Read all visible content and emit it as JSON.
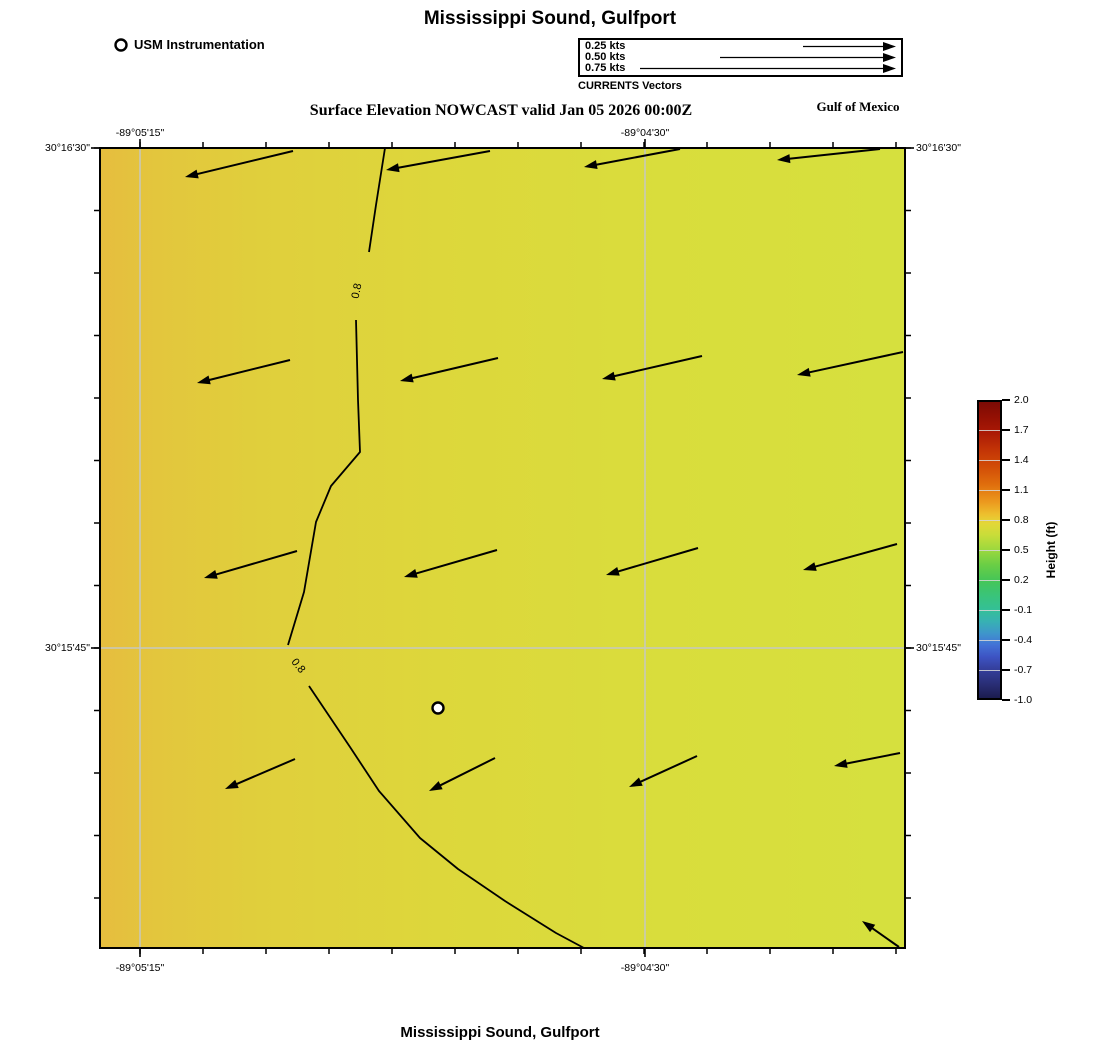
{
  "titles": {
    "top": "Mississippi Sound, Gulfport",
    "subtitle": "Surface Elevation NOWCAST valid Jan 05 2026 00:00Z",
    "region": "Gulf of Mexico",
    "bottom": "Mississippi Sound, Gulfport"
  },
  "station_legend": {
    "label": "USM Instrumentation"
  },
  "vector_legend": {
    "caption": "CURRENTS Vectors",
    "entries": [
      {
        "label": "0.25 kts",
        "length_px": 93
      },
      {
        "label": "0.50 kts",
        "length_px": 176
      },
      {
        "label": "0.75 kts",
        "length_px": 256
      }
    ]
  },
  "map_axes": {
    "top": [
      {
        "text": "-89°05'15\"",
        "x": 140
      },
      {
        "text": "-89°04'30\"",
        "x": 645
      }
    ],
    "bottom": [
      {
        "text": "-89°05'15\"",
        "x": 140
      },
      {
        "text": "-89°04'30\"",
        "x": 645
      }
    ],
    "left": [
      {
        "text": "30°16'30\"",
        "y": 148
      },
      {
        "text": "30°15'45\"",
        "y": 648
      }
    ],
    "right": [
      {
        "text": "30°16'30\"",
        "y": 148
      },
      {
        "text": "30°15'45\"",
        "y": 648
      }
    ]
  },
  "colorbar": {
    "label": "Height (ft)",
    "ticks": [
      "2.0",
      "1.7",
      "1.4",
      "1.1",
      "0.8",
      "0.5",
      "0.2",
      "-0.1",
      "-0.4",
      "-0.7",
      "-1.0"
    ],
    "max": 2.0,
    "min": -1.0,
    "tick_step": 0.3,
    "gradient": [
      {
        "p": 0.0,
        "c": "#7c0b05"
      },
      {
        "p": 0.05,
        "c": "#931004"
      },
      {
        "p": 0.1,
        "c": "#a91805"
      },
      {
        "p": 0.16,
        "c": "#c23306"
      },
      {
        "p": 0.22,
        "c": "#d24d07"
      },
      {
        "p": 0.28,
        "c": "#e06f0d"
      },
      {
        "p": 0.34,
        "c": "#ec9b1f"
      },
      {
        "p": 0.38,
        "c": "#edc02e"
      },
      {
        "p": 0.41,
        "c": "#e3d738"
      },
      {
        "p": 0.45,
        "c": "#c8dd39"
      },
      {
        "p": 0.5,
        "c": "#9bd83e"
      },
      {
        "p": 0.55,
        "c": "#6ace45"
      },
      {
        "p": 0.6,
        "c": "#47c656"
      },
      {
        "p": 0.65,
        "c": "#3ac477"
      },
      {
        "p": 0.7,
        "c": "#34c096"
      },
      {
        "p": 0.74,
        "c": "#37b2b2"
      },
      {
        "p": 0.78,
        "c": "#3e97ca"
      },
      {
        "p": 0.82,
        "c": "#4373d6"
      },
      {
        "p": 0.86,
        "c": "#3d54c4"
      },
      {
        "p": 0.9,
        "c": "#35409e"
      },
      {
        "p": 0.95,
        "c": "#2a2f78"
      },
      {
        "p": 1.0,
        "c": "#1c1c4f"
      }
    ]
  },
  "map_colors": {
    "gridline": "#c6c8c0",
    "contour": "#000000",
    "vector": "#000000",
    "fill_stops": [
      {
        "p": 0.0,
        "c": "#e6bd3e"
      },
      {
        "p": 0.07,
        "c": "#e3c63d"
      },
      {
        "p": 0.2,
        "c": "#e0cf3c"
      },
      {
        "p": 0.42,
        "c": "#ddd73b"
      },
      {
        "p": 0.7,
        "c": "#d9dd3c"
      },
      {
        "p": 1.0,
        "c": "#d6e03e"
      }
    ]
  },
  "chart_data": {
    "type": "heatmap",
    "title": "Mississippi Sound, Gulfport",
    "subtitle": "Surface Elevation NOWCAST valid Jan 05 2026 00:00Z",
    "valid_time": "Jan 05 2026 00:00Z",
    "field": "surface elevation (ft)",
    "field_range_in_view": [
      0.72,
      0.86
    ],
    "x_tick_labels": [
      "-89°05'15\"",
      "-89°04'30\""
    ],
    "y_tick_labels": [
      "30°16'30\"",
      "30°15'45\""
    ],
    "colorbar": {
      "label": "Height (ft)",
      "min": -1.0,
      "max": 2.0,
      "tick_step": 0.3
    },
    "gridlines_px": {
      "v": [
        140,
        645
      ],
      "h": [
        648
      ]
    },
    "contours": {
      "level": "0.8",
      "labels": [
        {
          "x": 357,
          "y": 291,
          "rot": -78
        },
        {
          "x": 298,
          "y": 666,
          "rot": 52
        }
      ],
      "segments": [
        [
          [
            385,
            148
          ],
          [
            376,
            205
          ],
          [
            369,
            252
          ]
        ],
        [
          [
            356,
            320
          ],
          [
            358,
            400
          ],
          [
            360,
            452
          ],
          [
            331,
            486
          ],
          [
            316,
            522
          ],
          [
            304,
            592
          ],
          [
            288,
            645
          ]
        ],
        [
          [
            309,
            686
          ],
          [
            350,
            747
          ],
          [
            379,
            791
          ],
          [
            420,
            838
          ],
          [
            458,
            869
          ],
          [
            505,
            901
          ],
          [
            556,
            933
          ],
          [
            584,
            948
          ]
        ]
      ]
    },
    "vectors": {
      "units": "kts",
      "legend_speeds": [
        0.25,
        0.5,
        0.75
      ],
      "direction": "westward / down-coast ebb flow, ~0.2-0.35 kts",
      "arrows": [
        [
          293,
          151,
          185,
          177
        ],
        [
          490,
          151,
          386,
          170
        ],
        [
          680,
          149,
          584,
          167
        ],
        [
          880,
          149,
          777,
          160
        ],
        [
          290,
          360,
          197,
          383
        ],
        [
          498,
          358,
          400,
          381
        ],
        [
          702,
          356,
          602,
          379
        ],
        [
          903,
          352,
          797,
          375
        ],
        [
          297,
          551,
          204,
          578
        ],
        [
          497,
          550,
          404,
          577
        ],
        [
          698,
          548,
          606,
          575
        ],
        [
          897,
          544,
          803,
          570
        ],
        [
          295,
          759,
          225,
          789
        ],
        [
          495,
          758,
          429,
          791
        ],
        [
          697,
          756,
          629,
          787
        ],
        [
          900,
          753,
          834,
          766
        ],
        [
          899,
          947,
          862,
          921
        ]
      ]
    },
    "station": {
      "name": "USM Instrumentation",
      "x": 438,
      "y": 708
    }
  }
}
